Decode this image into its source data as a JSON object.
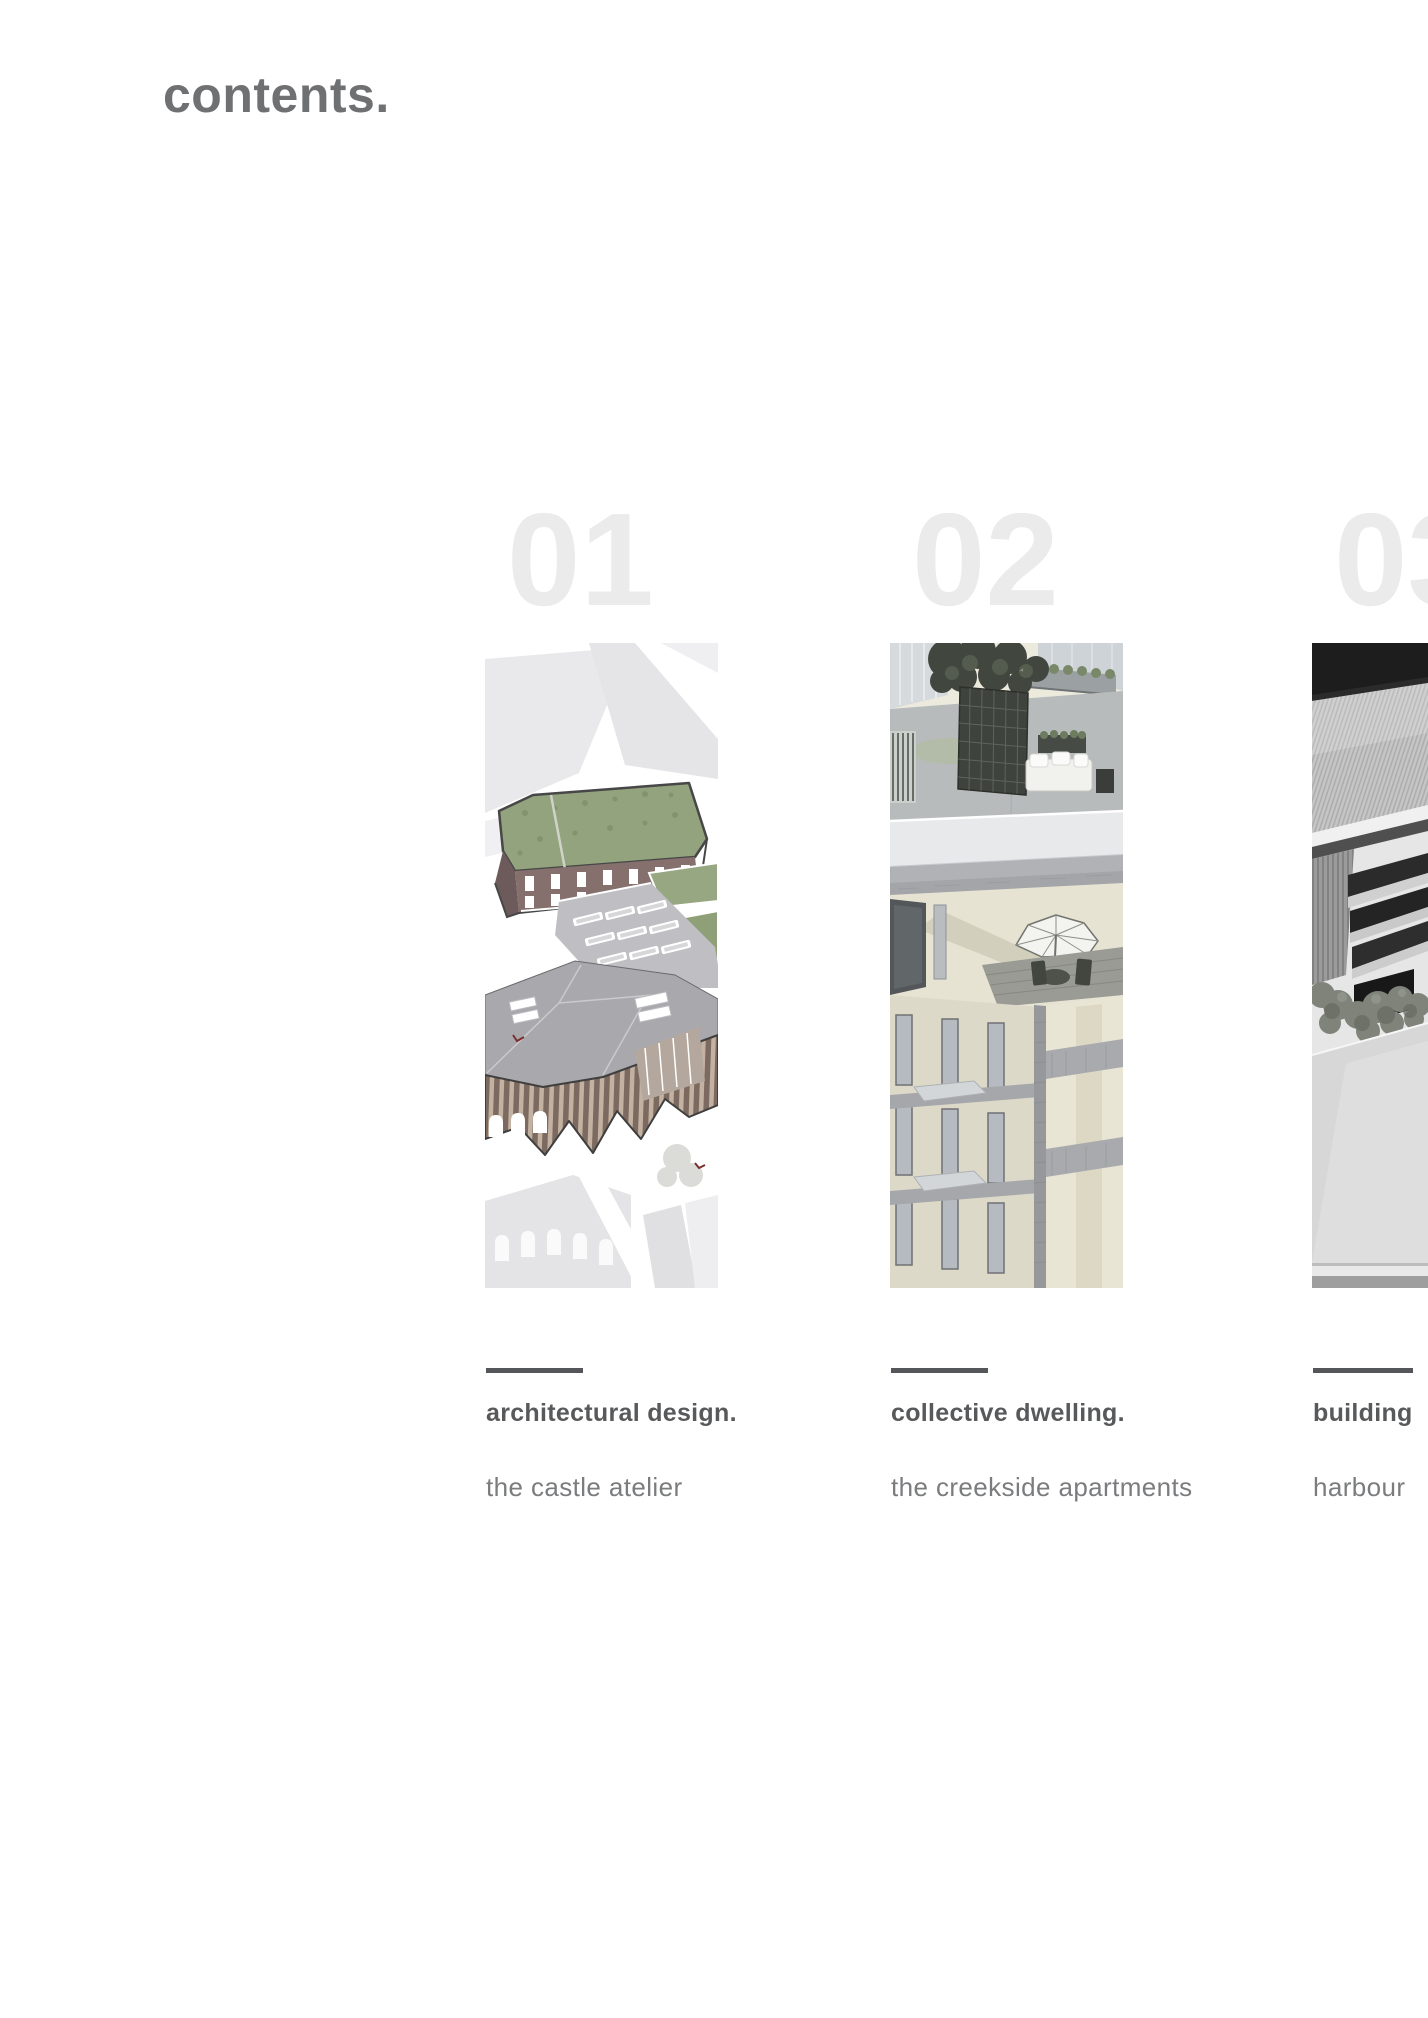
{
  "page": {
    "title": "contents."
  },
  "sections": [
    {
      "number": "01",
      "title": "architectural design.",
      "subtitle": "the castle atelier",
      "image": "castle-atelier-aerial-axonometric-render"
    },
    {
      "number": "02",
      "title": "collective dwelling.",
      "subtitle": "the creekside apartments",
      "image": "creekside-apartments-rooftop-render"
    },
    {
      "number": "03",
      "title": "building",
      "subtitle": "harbour",
      "image": "harbour-physical-model-photo"
    }
  ],
  "colors": {
    "page_title": "#6f7072",
    "ghost_number": "#ebebec",
    "rule": "#55565a",
    "section_title": "#58595b",
    "section_subtitle": "#7b7c7e",
    "background": "#ffffff"
  }
}
